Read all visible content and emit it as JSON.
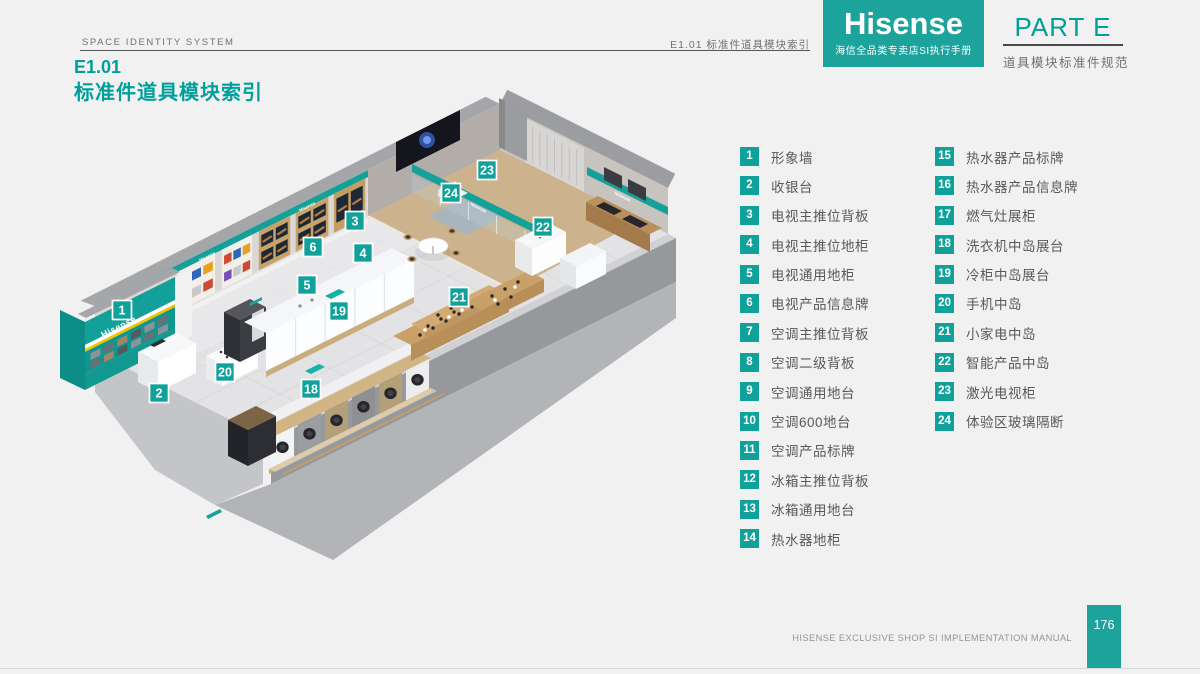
{
  "header": {
    "left": "SPACE IDENTITY SYSTEM",
    "ref": "E1.01  标准件道具模块索引"
  },
  "brand": {
    "logo": "Hisense",
    "sub": "海信全品类专卖店SI执行手册"
  },
  "part": {
    "label": "PART E",
    "subtitle": "道具模块标准件规范"
  },
  "heading": {
    "code": "E1.01",
    "title": "标准件道具模块索引"
  },
  "plan": {
    "brand_label": "Hisense",
    "badges": [
      {
        "n": "1",
        "x": 122,
        "y": 310
      },
      {
        "n": "2",
        "x": 159,
        "y": 393
      },
      {
        "n": "3",
        "x": 355,
        "y": 221
      },
      {
        "n": "4",
        "x": 363,
        "y": 253
      },
      {
        "n": "5",
        "x": 307,
        "y": 285
      },
      {
        "n": "6",
        "x": 313,
        "y": 247
      },
      {
        "n": "18",
        "x": 311,
        "y": 389
      },
      {
        "n": "19",
        "x": 339,
        "y": 311
      },
      {
        "n": "20",
        "x": 225,
        "y": 372
      },
      {
        "n": "21",
        "x": 459,
        "y": 297
      },
      {
        "n": "22",
        "x": 543,
        "y": 227
      },
      {
        "n": "23",
        "x": 487,
        "y": 170
      },
      {
        "n": "24",
        "x": 451,
        "y": 193
      }
    ]
  },
  "legend": {
    "items": [
      {
        "num": "1",
        "label": "形象墙"
      },
      {
        "num": "2",
        "label": "收银台"
      },
      {
        "num": "3",
        "label": "电视主推位背板"
      },
      {
        "num": "4",
        "label": "电视主推位地柜"
      },
      {
        "num": "5",
        "label": "电视通用地柜"
      },
      {
        "num": "6",
        "label": "电视产品信息牌"
      },
      {
        "num": "7",
        "label": "空调主推位背板"
      },
      {
        "num": "8",
        "label": "空调二级背板"
      },
      {
        "num": "9",
        "label": "空调通用地台"
      },
      {
        "num": "10",
        "label": "空调600地台"
      },
      {
        "num": "11",
        "label": "空调产品标牌"
      },
      {
        "num": "12",
        "label": "冰箱主推位背板"
      },
      {
        "num": "13",
        "label": "冰箱通用地台"
      },
      {
        "num": "14",
        "label": "热水器地柜"
      },
      {
        "num": "15",
        "label": "热水器产品标牌"
      },
      {
        "num": "16",
        "label": "热水器产品信息牌"
      },
      {
        "num": "17",
        "label": "燃气灶展柜"
      },
      {
        "num": "18",
        "label": "洗衣机中岛展台"
      },
      {
        "num": "19",
        "label": "冷柜中岛展台"
      },
      {
        "num": "20",
        "label": "手机中岛"
      },
      {
        "num": "21",
        "label": "小家电中岛"
      },
      {
        "num": "22",
        "label": "智能产品中岛"
      },
      {
        "num": "23",
        "label": "激光电视柜"
      },
      {
        "num": "24",
        "label": "体验区玻璃隔断"
      }
    ]
  },
  "footer": {
    "manual": "HISENSE EXCLUSIVE SHOP SI IMPLEMENTATION MANUAL",
    "page": "176"
  },
  "colors": {
    "teal": "#0fa19a",
    "heading_teal": "#009f99",
    "wall_gray": "#97989c",
    "wood": "#c9a269",
    "page_bg": "#f1f1f2"
  }
}
